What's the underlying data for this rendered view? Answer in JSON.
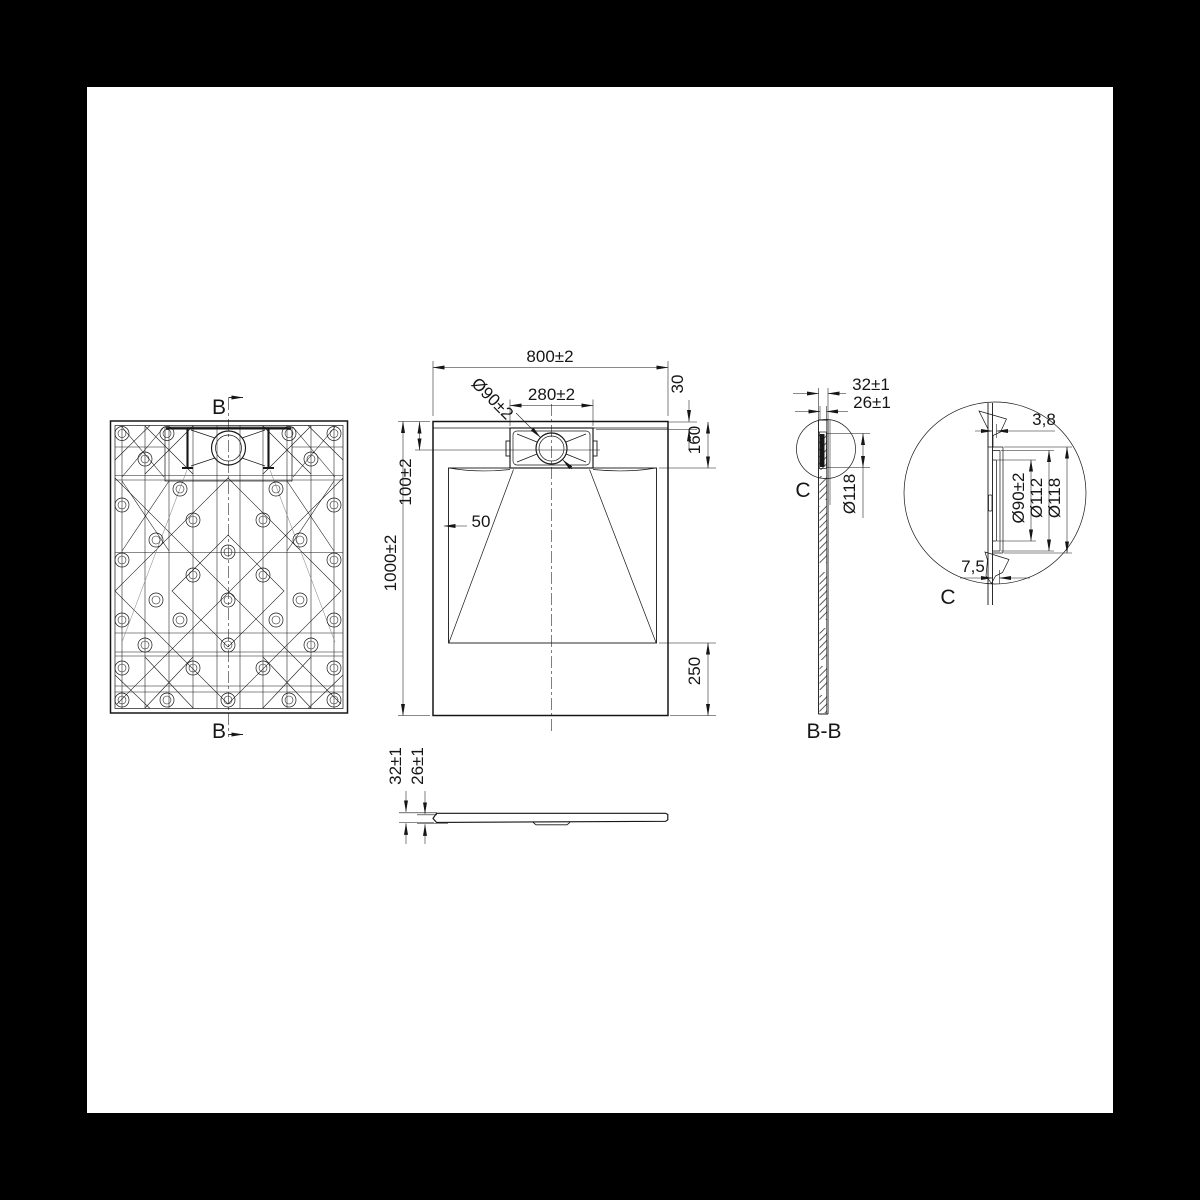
{
  "canvas": {
    "background": "#000000",
    "paper": "#ffffff",
    "ink": "#161616"
  },
  "bottom_view": {
    "section_label_top": "B",
    "section_label_bottom": "B"
  },
  "top_view": {
    "dim_width": "800±2",
    "dim_drain": "Ø90±2",
    "dim_cover": "280±2",
    "dim_edge_gap": "30",
    "dim_recess": "160",
    "dim_center": "100±2",
    "dim_border": "50",
    "dim_length": "1000±2",
    "dim_flat": "250"
  },
  "side_view": {
    "dim_total": "32±1",
    "dim_base": "26±1"
  },
  "section_bb": {
    "dim_total": "32±1",
    "dim_base": "26±1",
    "dim_flange": "Ø118",
    "detail_ref": "C",
    "title": "B-B"
  },
  "detail_c": {
    "dim_lip": "3,8",
    "dim_bore": "Ø90±2",
    "dim_mid": "Ø112",
    "dim_outer": "Ø118",
    "dim_inset": "7,5",
    "title": "C"
  }
}
